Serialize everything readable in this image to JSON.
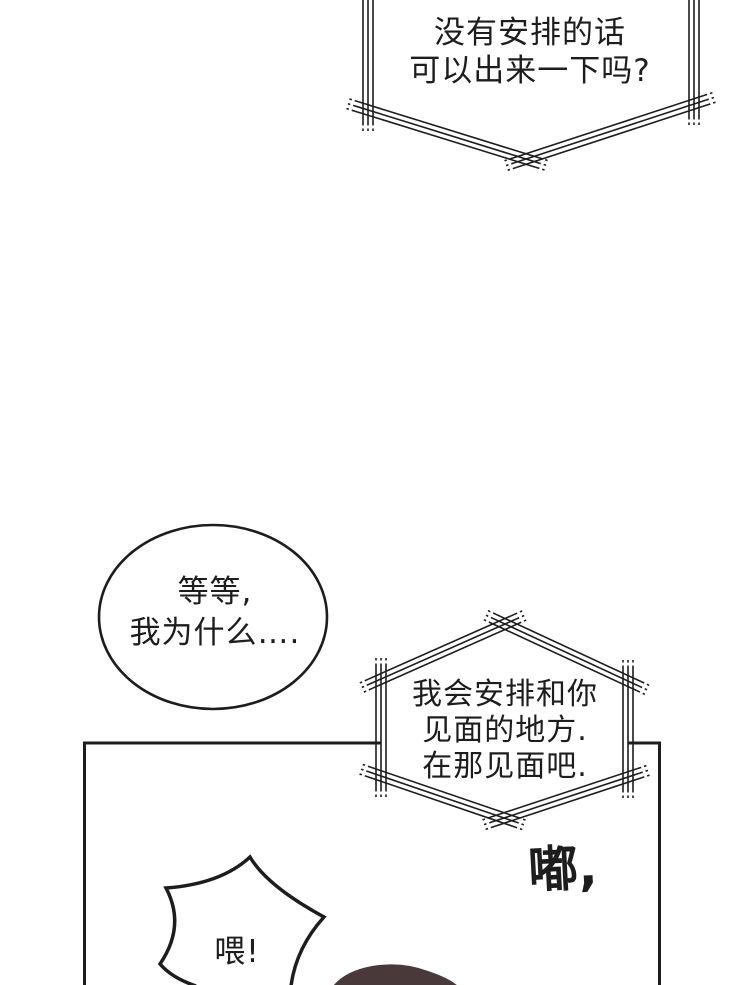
{
  "page": {
    "kind": "comic-page",
    "background_color": "#ffffff",
    "ink_color": "#1d1d1d"
  },
  "bubbles": {
    "phone_top": {
      "shape": "phone-call-hexagon",
      "lines": [
        "没有安排的话",
        "可以出来一下吗?"
      ]
    },
    "thought_oval": {
      "shape": "ellipse",
      "lines": [
        "等等,",
        "我为什么…."
      ]
    },
    "phone_mid": {
      "shape": "phone-call-hexagon",
      "lines": [
        "我会安排和你",
        "见面的地方.",
        "在那见面吧."
      ]
    },
    "shout_burst": {
      "shape": "burst",
      "lines": [
        "喂!"
      ]
    }
  },
  "sfx": {
    "text": "嘟,"
  },
  "colors": {
    "hair": "#4a393b",
    "line": "#1d1d1d"
  }
}
